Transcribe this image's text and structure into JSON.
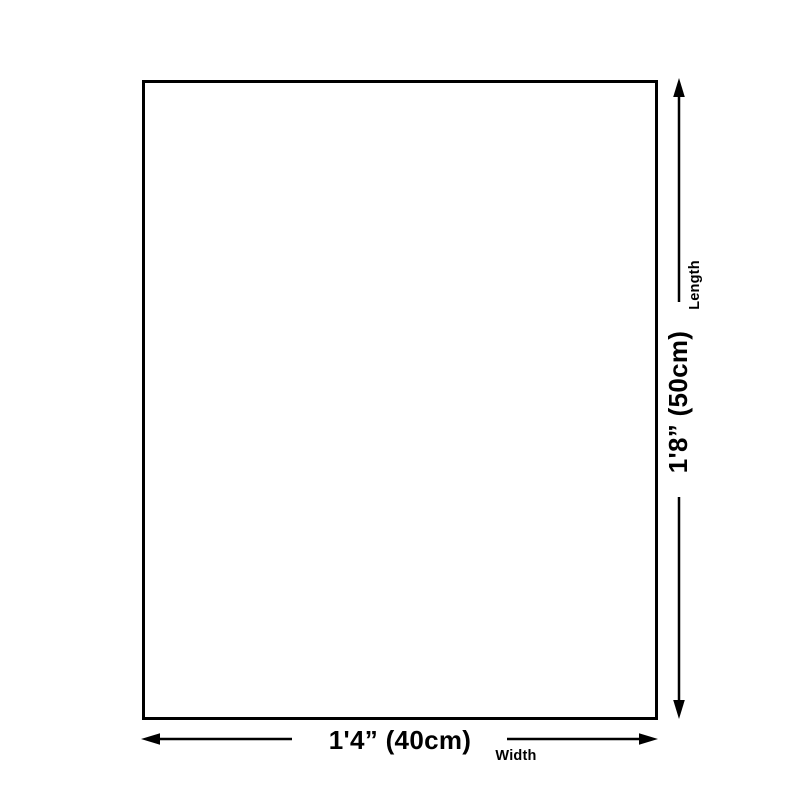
{
  "diagram": {
    "background_color": "#ffffff",
    "line_color": "#000000",
    "width_dimension": {
      "value": "1'4” (40cm)",
      "axis_label": "Width"
    },
    "length_dimension": {
      "value": "1'8” (50cm)",
      "axis_label": "Length"
    }
  }
}
